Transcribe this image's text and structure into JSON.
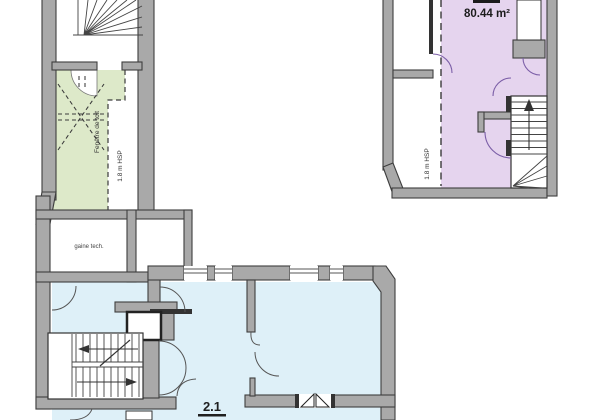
{
  "plan": {
    "colors": {
      "wall_fill": "#a9a9a9",
      "wall_stroke": "#3e3e3e",
      "room_green": "#dde9c9",
      "room_purple": "#e5d4ee",
      "room_blue": "#def0f8",
      "door_arc_purple": "#7b5ea7",
      "text": "#222222"
    },
    "labels": {
      "upper_unit_area": "80.44 m²",
      "upper_unit_hsp": "1.8 m HSP",
      "attic_skylight": "Fenêtre de toit",
      "attic_hsp": "1.8 m HSP",
      "duct_room": "gaine tech.",
      "lower_unit_number": "2.1"
    }
  }
}
